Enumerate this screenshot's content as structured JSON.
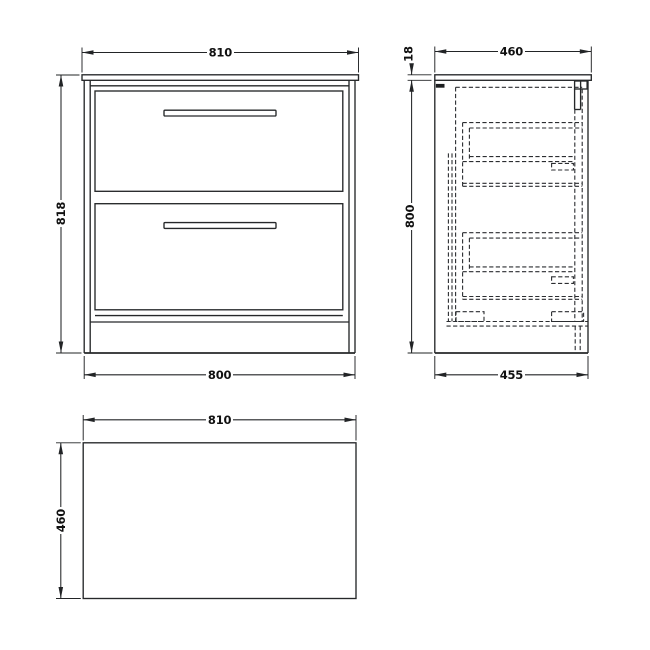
{
  "colors": {
    "background": "#ffffff",
    "line": "#26282a",
    "dimension_text": "#111111"
  },
  "views": {
    "front": {
      "dim_width_top": "810",
      "dim_height_left": "818",
      "dim_width_bottom": "800"
    },
    "side": {
      "dim_depth_top": "460",
      "dim_worktop_thickness": "18",
      "dim_height_left": "800",
      "dim_depth_bottom": "455"
    },
    "plan": {
      "dim_width_top": "810",
      "dim_depth_left": "460"
    }
  }
}
